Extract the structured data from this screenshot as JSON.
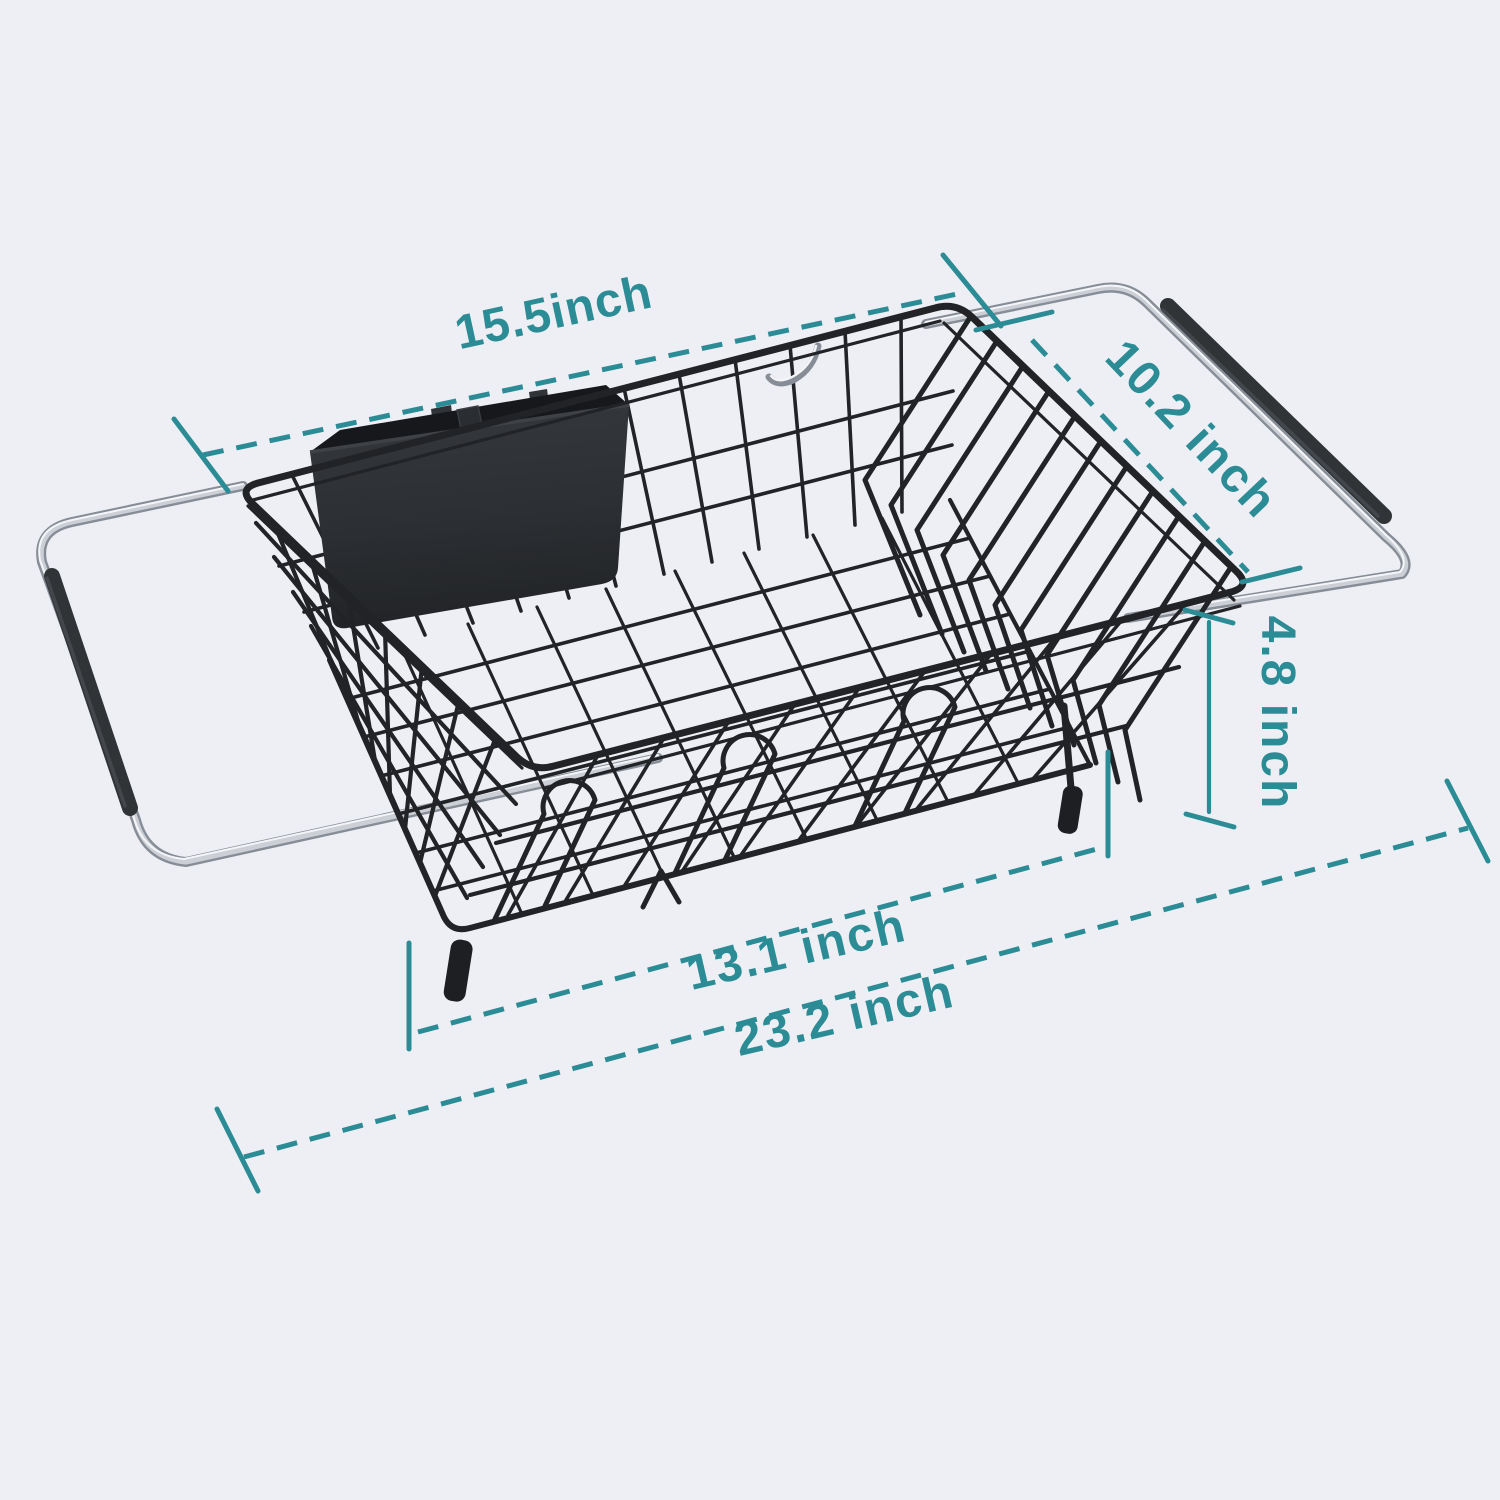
{
  "canvas": {
    "background": "#edeff4",
    "width": 1500,
    "height": 1500
  },
  "product": {
    "name": "Expandable over-the-sink dish drying rack with utensil holder",
    "parts": {
      "basket": "black wire dish basket with plate slots",
      "utensil_holder": "black two-compartment utensil holder",
      "left_handle": "extendable chrome arm with non-slip grip",
      "right_handle": "extendable chrome arm with non-slip grip",
      "feet": "rubber corner feet"
    },
    "colors": {
      "wire": "#222326",
      "chrome_dark": "#878d96",
      "chrome_mid": "#ccd0d6",
      "chrome_light": "#f3f5f8",
      "grip": "#313437",
      "grip_highlight": "#4b4f54",
      "caddy_face": "#2e3135",
      "caddy_interior": "#17181b",
      "caddy_edge": "#3e4146"
    }
  },
  "dimensions": {
    "accent_color": "#2c8c96",
    "labels": {
      "top_width": "15.5inch",
      "depth": "10.2 inch",
      "height": "4.8 inch",
      "basket_length": "13.1 inch",
      "extended_length": "23.2 inch"
    }
  }
}
